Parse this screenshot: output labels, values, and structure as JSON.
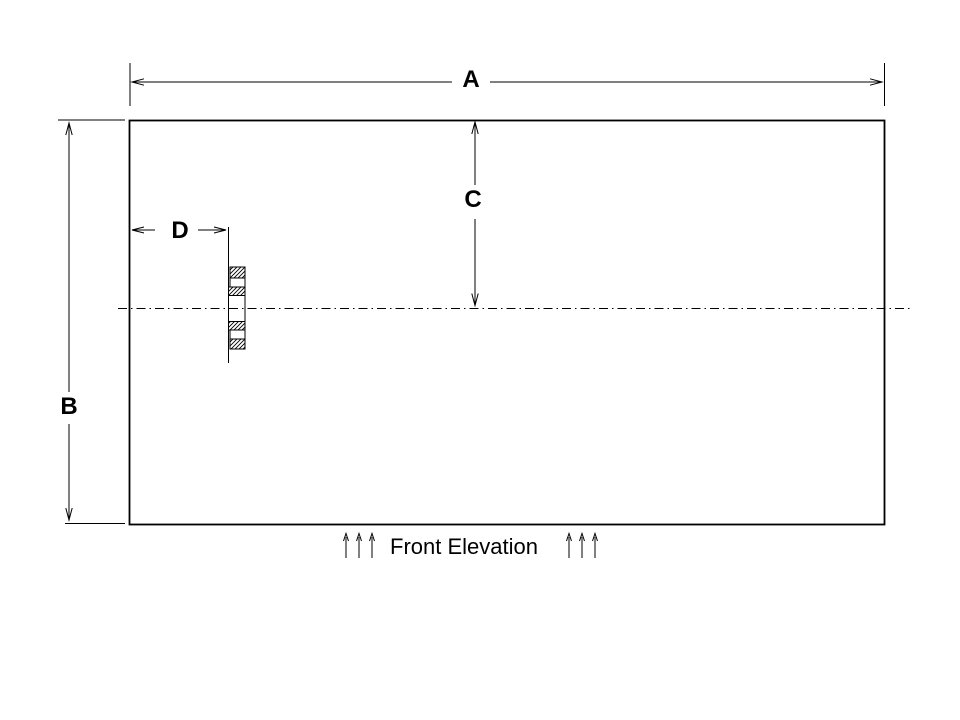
{
  "colors": {
    "background": "#ffffff",
    "line": "#000000",
    "text": "#000000"
  },
  "drawing": {
    "caption": "Front Elevation",
    "dimension_labels": {
      "a": "A",
      "b": "B",
      "c": "C",
      "d": "D"
    },
    "icons": {
      "caption_flank_left": "three-up-arrows",
      "caption_flank_right": "three-up-arrows"
    }
  }
}
